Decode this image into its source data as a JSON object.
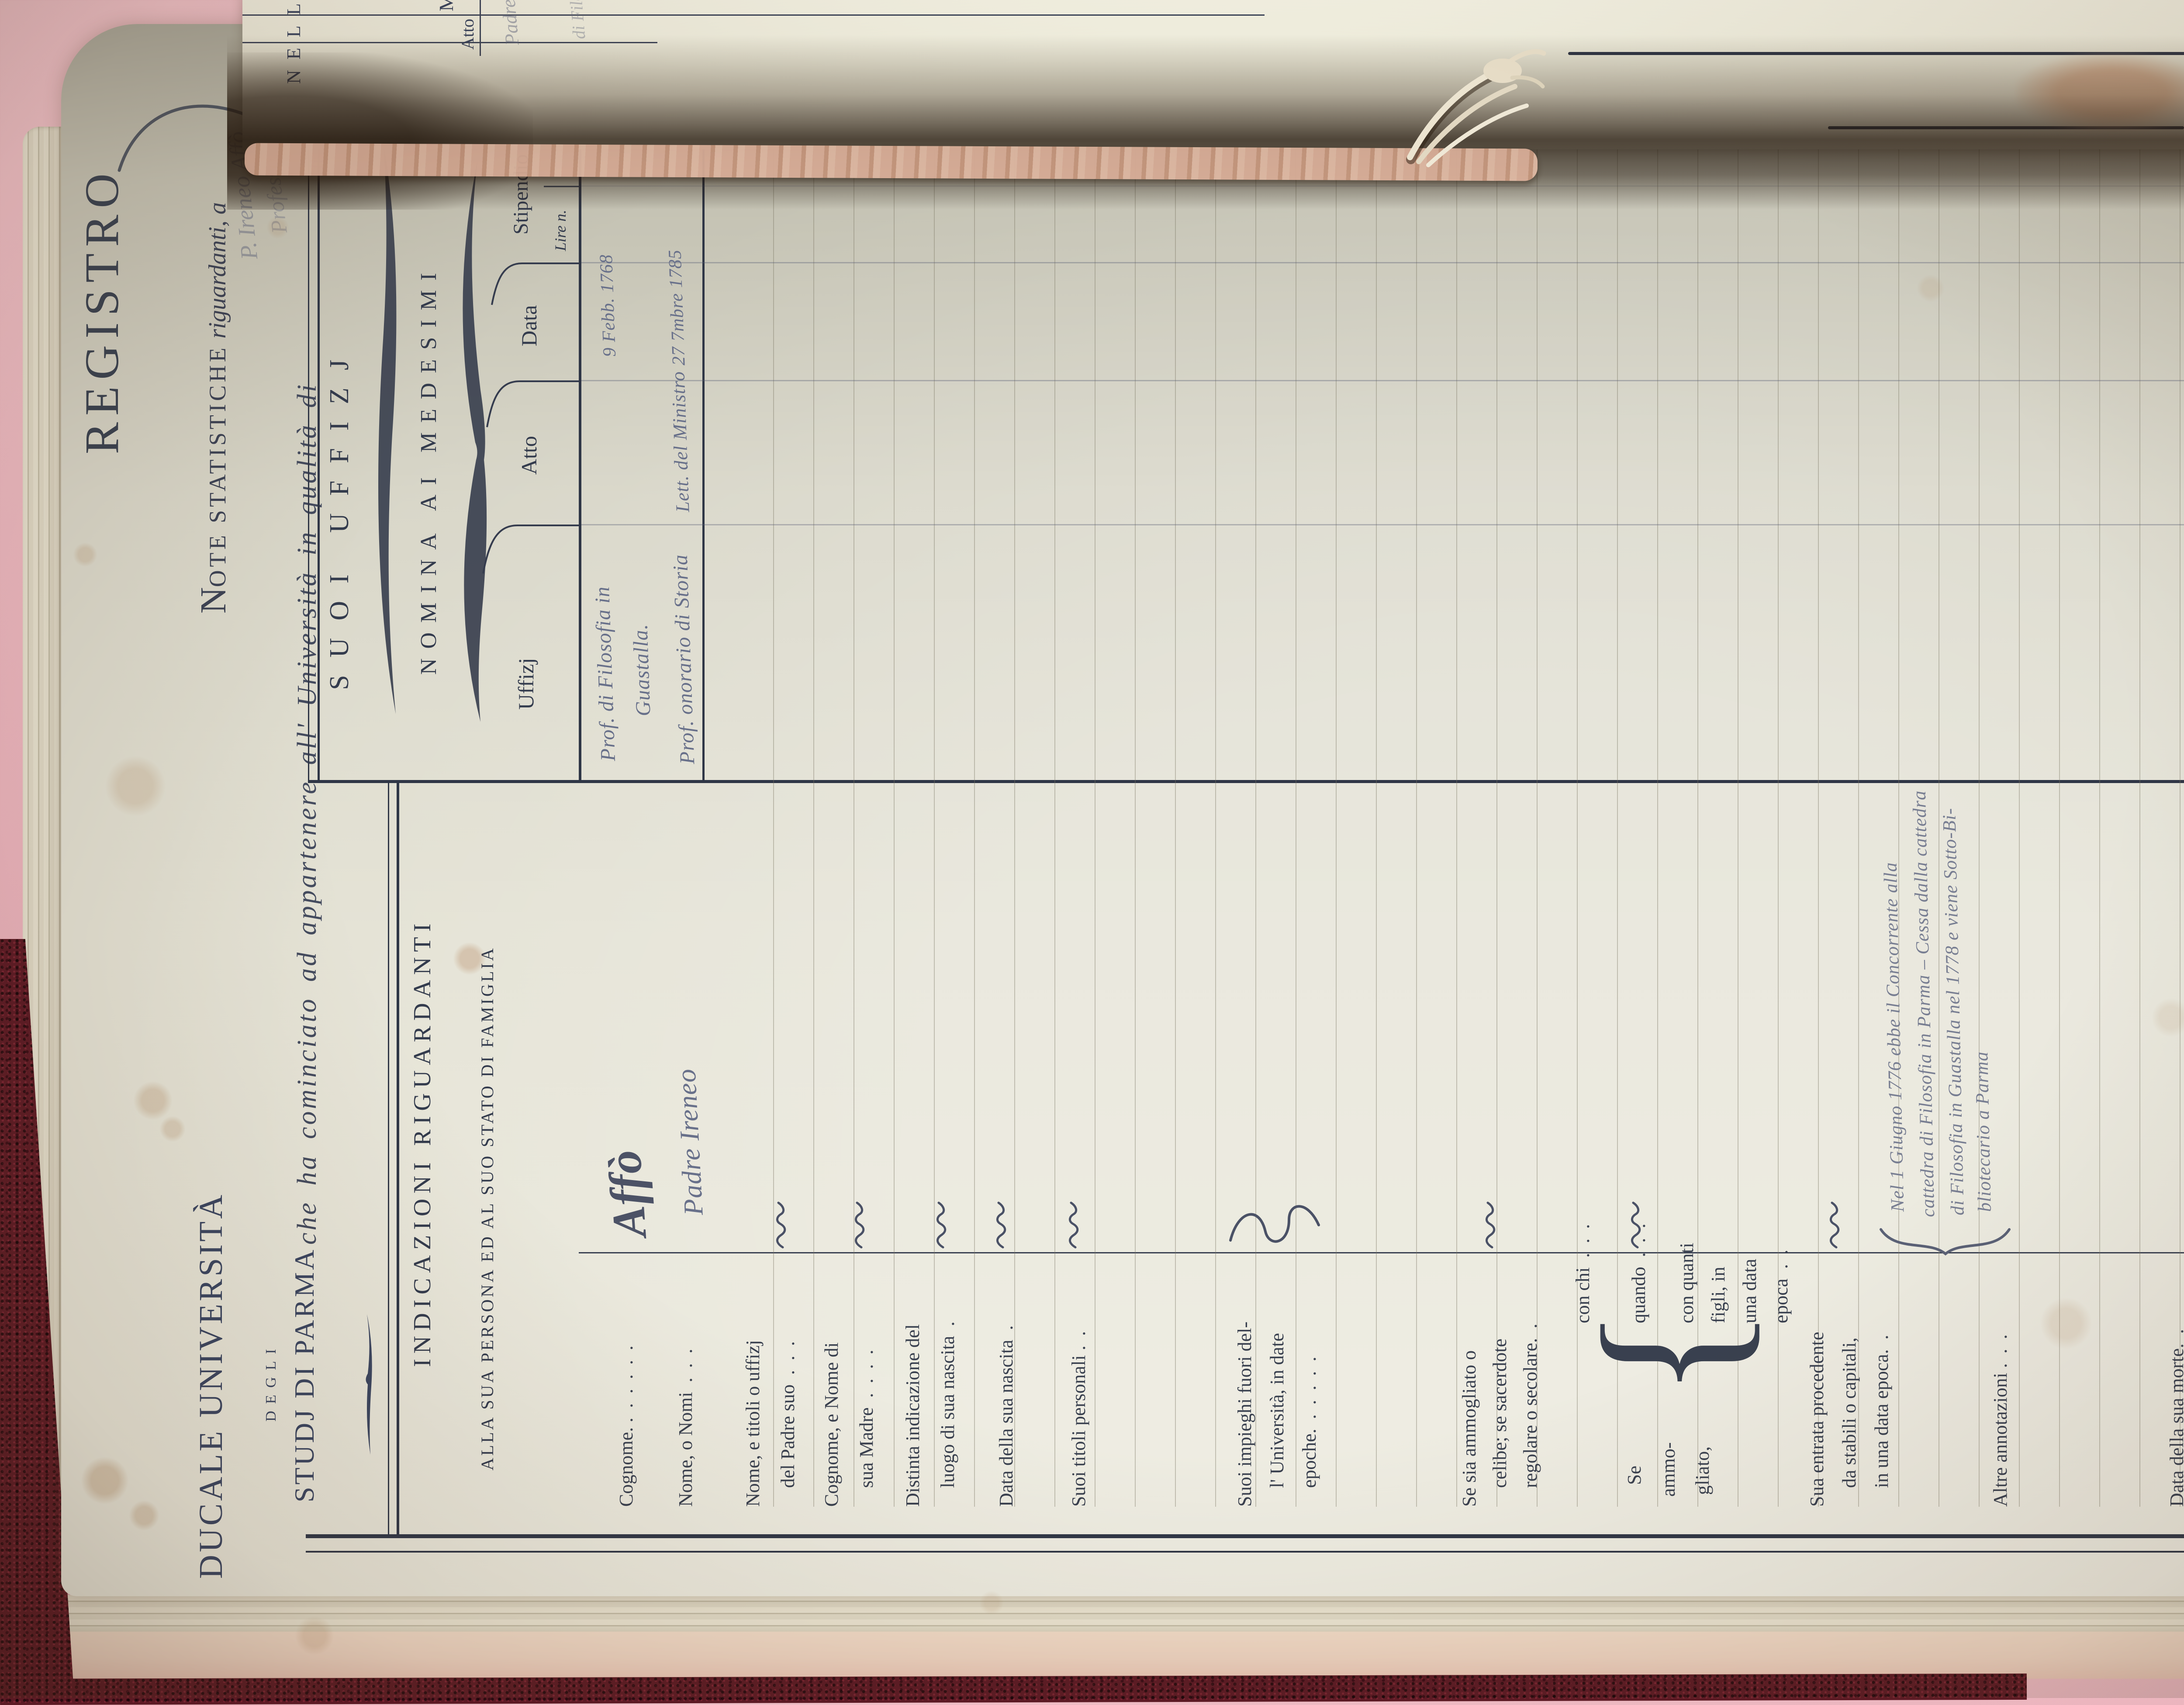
{
  "header": {
    "registro": "REGISTRO",
    "note": {
      "initial": "N",
      "caps": "OTE STATISTICHE",
      "italic": " riguardanti, a"
    },
    "name_script": "P. Ireneo Affò",
    "che_line": "che ha cominciato ad appartenere all' Università in qualità di",
    "qualita_script": "Professore",
    "qualita_script2": "di Filosofia"
  },
  "university_block": {
    "line1": "DUCALE UNIVERSITÀ",
    "line2": "DEGLI",
    "line3": "STUDJ DI PARMA"
  },
  "left_section": {
    "title": "INDICAZIONI RIGUARDANTI",
    "subtitle": "ALLA SUA PERSONA ED AL SUO STATO DI FAMIGLIA",
    "rows": [
      {
        "lines": [
          "Cognome. .  .  .  .  .  ."
        ],
        "answer": "Affò"
      },
      {
        "lines": [
          "Nome, o Nomi  .  .  ."
        ],
        "answer": "Padre Ireneo"
      },
      {
        "lines": [
          "Nome, e titoli o uffizj",
          "del Padre suo  .  .  ."
        ]
      },
      {
        "lines": [
          "Cognome, e Nome di",
          "sua Madre  .  .  .  ."
        ]
      },
      {
        "lines": [
          "Distinta indicazione del",
          "luogo di sua nascita  ."
        ]
      },
      {
        "lines": [
          "Data della sua nascita  ."
        ]
      },
      {
        "lines": [
          "Suoi titoli personali .  ."
        ]
      },
      {
        "lines": [
          "Suoi impieghi fuori del-",
          "l' Università, in date",
          "epoche.  .  .  .  .  ."
        ]
      },
      {
        "lines": [
          "Se sia ammogliato o",
          "celibe; se sacerdote",
          "regolare o secolare.  ."
        ]
      },
      {
        "se_block": {
          "intro": [
            "Se",
            "ammo-",
            "gliato,"
          ],
          "brace": "{",
          "items": [
            "con chi  .  .  .",
            "quando  .  .  .",
            "con quanti",
            "figli, in",
            "una data",
            "epoca  .  ."
          ]
        }
      },
      {
        "lines": [
          "Sua entrata procedente",
          "da stabili o capitali,",
          "in una data epoca.  ."
        ]
      },
      {
        "lines": [
          "Altre annotazioni .  .  ."
        ],
        "annotation": [
          "Nel 1 Giugno 1776 ebbe il Concorrente alla",
          "cattedra di Filosofia in Parma – Cessa dalla cattedra",
          "di Filosofia in Guastalla nel 1778 e viene Sotto-Bi-",
          "bliotecario a Parma"
        ]
      },
      {
        "lines": [
          "Data della sua morte.  ."
        ]
      }
    ]
  },
  "right_section": {
    "banner": "SUOI UFFIZJ",
    "subbanner": "NOMINA AI MEDESIMI",
    "columns": [
      "Uffizj",
      "Atto",
      "Data",
      "Stipendio"
    ],
    "stipendio_sub": [
      "Lire n.",
      "c."
    ],
    "entries": [
      {
        "uffizj_l1": "Prof. di Filosofia in",
        "uffizj_l2": "Guastalla.",
        "atto": "",
        "data": "9 Febb. 1768"
      },
      {
        "uffizj_l1": "Prof. onorario di Storia",
        "atto": "Lett. del Ministro",
        "data": "27 7mbre 1785"
      }
    ]
  },
  "facing_page": {
    "fragment_caps": "NELL",
    "fragment_m": "M",
    "fragment_atto": "Atto",
    "script1": "Padre",
    "script2": "di Filos."
  },
  "colors": {
    "paper": "#e3e1d3",
    "ink": "#333b4d",
    "handwriting": "#68708a",
    "cover": "#5c1a24",
    "table_cloth": "#ecb6bf"
  }
}
